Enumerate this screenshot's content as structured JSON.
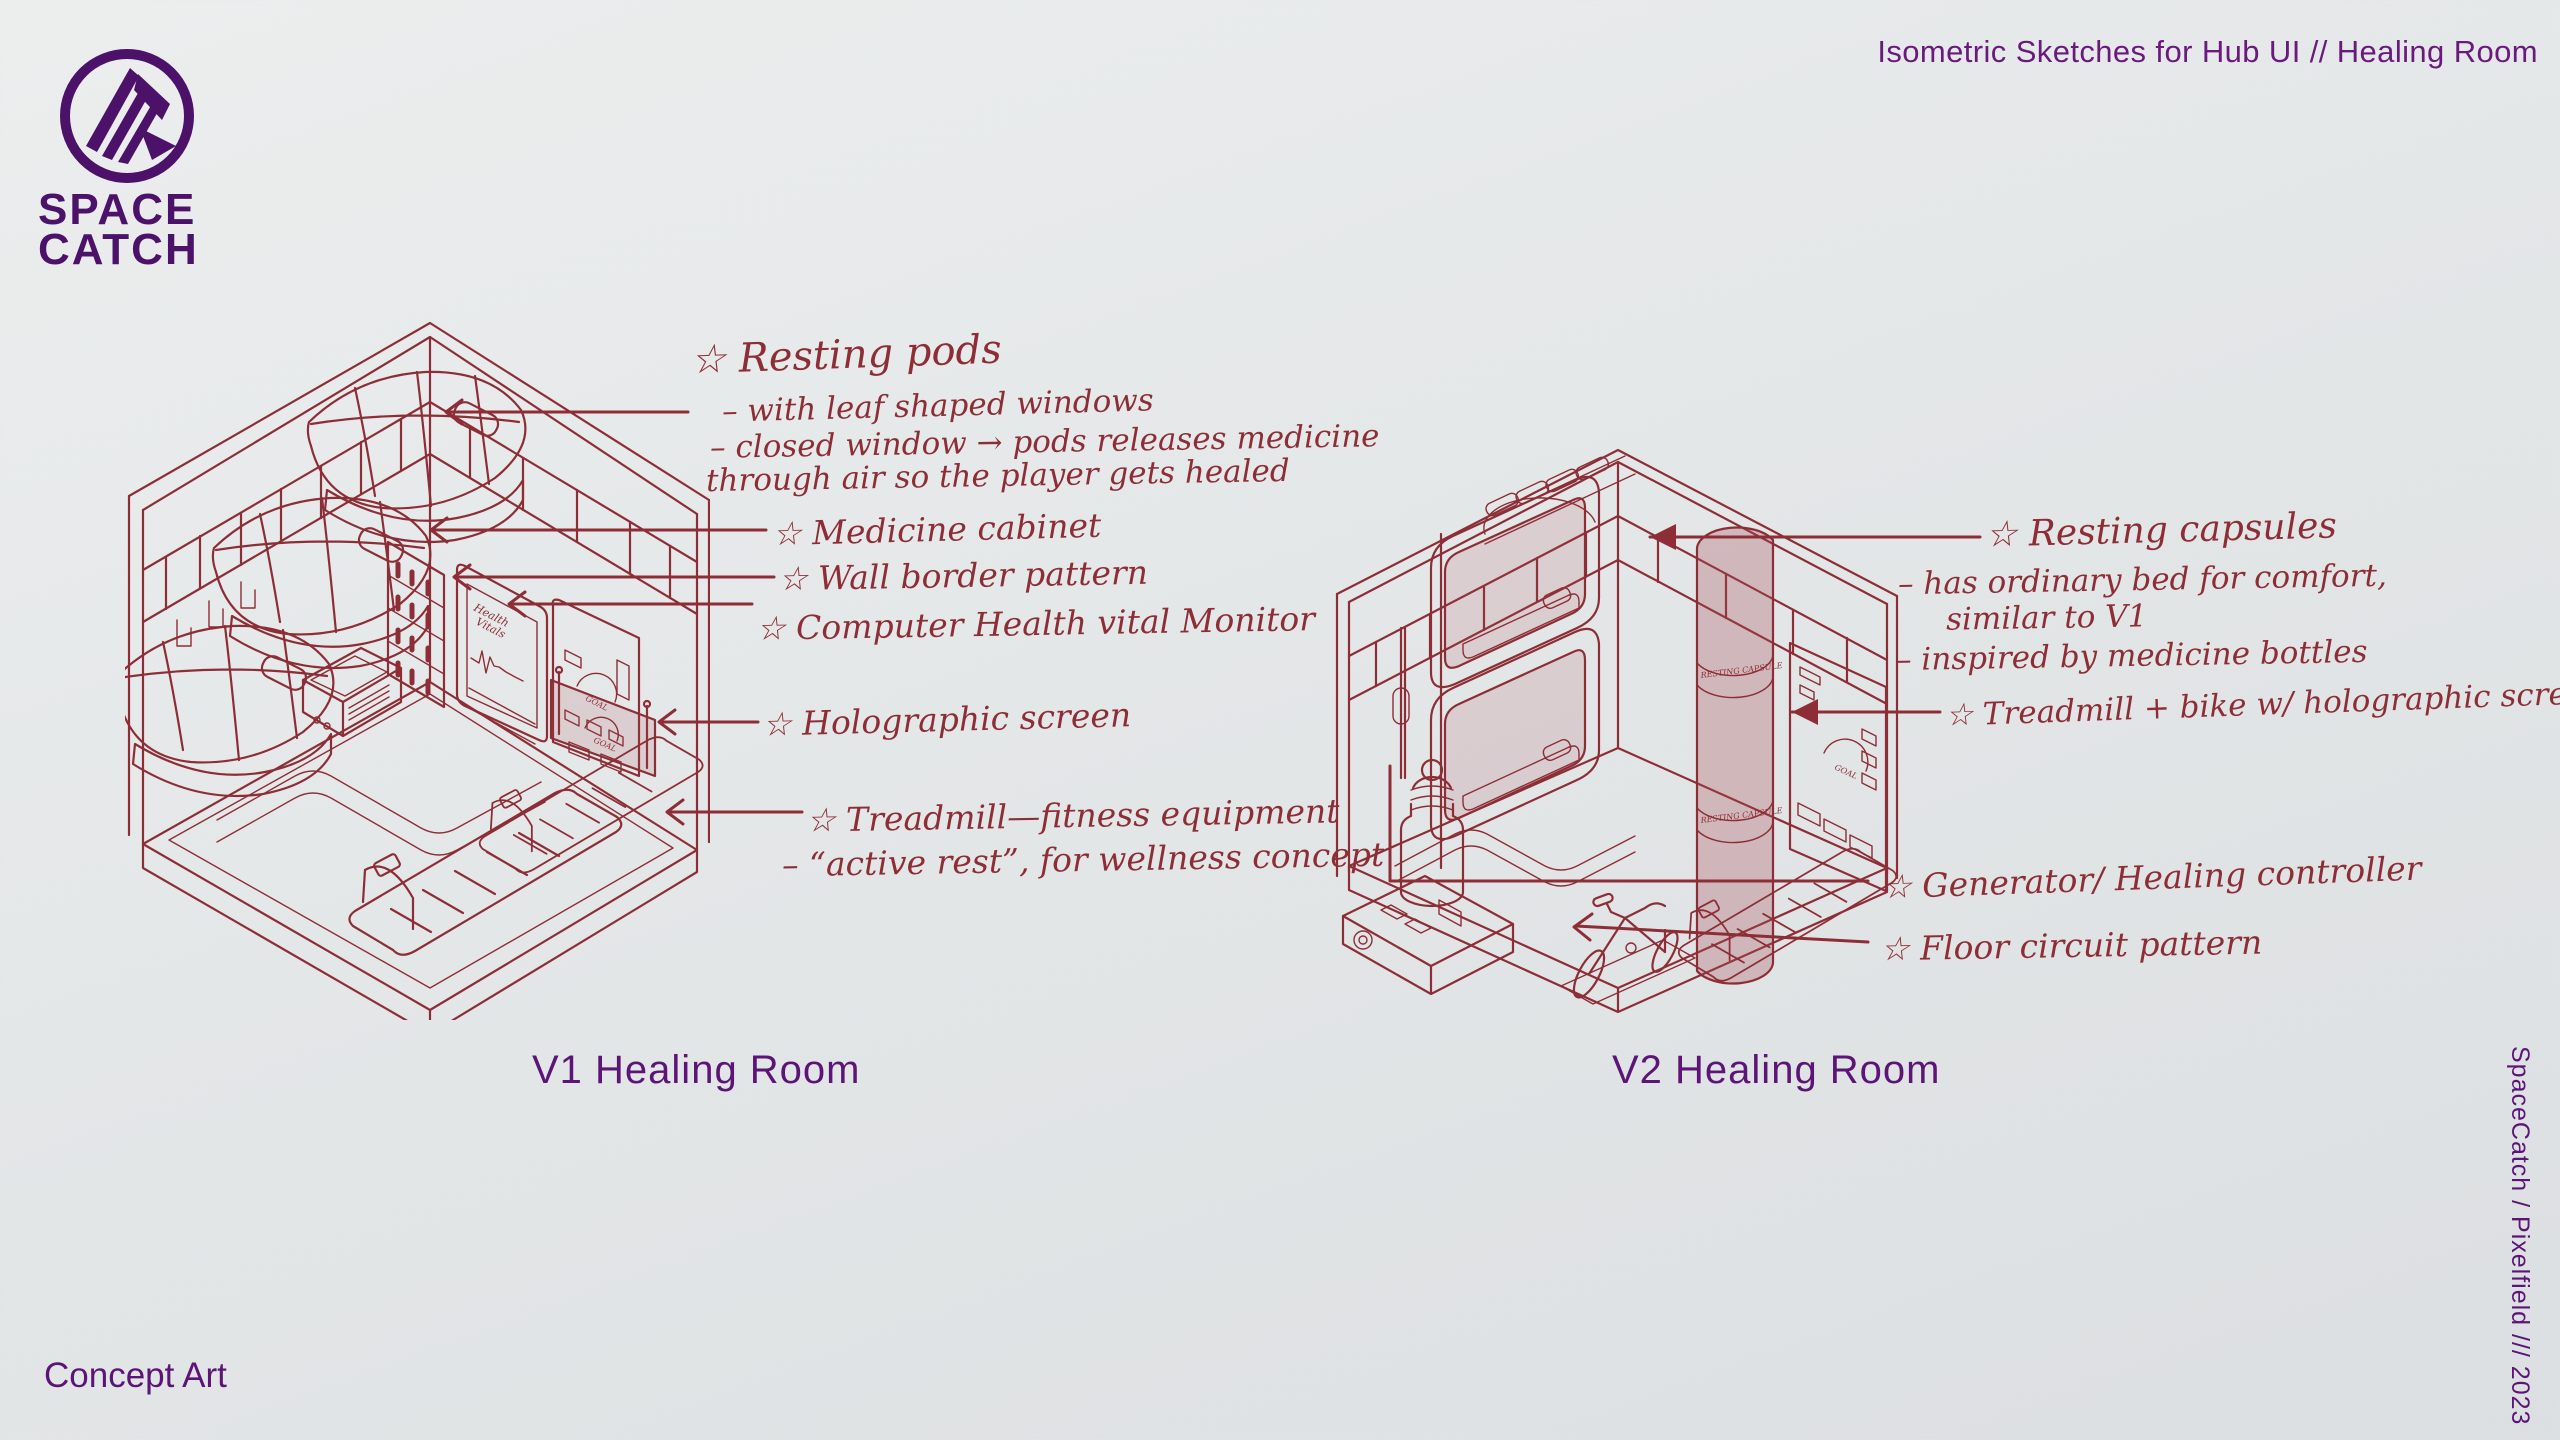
{
  "header": {
    "title": "Isometric Sketches for Hub UI // Healing Room"
  },
  "brand": {
    "line1": "SPACE",
    "line2": "CATCH",
    "logo_icon": "spacecatch-mountain-logo"
  },
  "v1": {
    "label": "V1 Healing Room",
    "annotations": [
      "☆ Resting pods",
      "– with leaf shaped windows",
      "– closed window → pods releases medicine",
      "through air so the player gets healed",
      "☆ Medicine cabinet",
      "☆ Wall border pattern",
      "☆ Computer Health vital Monitor",
      "☆ Holographic screen",
      "☆ Treadmill—fitness equipment",
      "– “active rest”, for wellness concept"
    ]
  },
  "v2": {
    "label": "V2 Healing Room",
    "annotations": [
      "☆ Resting capsules",
      "– has ordinary bed for comfort,",
      "similar to V1",
      "– inspired by medicine bottles",
      "☆ Treadmill + bike w/ holographic screens",
      "☆ Generator/ Healing controller",
      "☆ Floor circuit pattern"
    ]
  },
  "drawing_labels": {
    "capsule_band": "RESTING CAPSULE",
    "monitor_line1": "Health",
    "monitor_line2": "Vitals",
    "gauge": "GOAL"
  },
  "footer": {
    "left": "Concept Art",
    "credit": "SpaceCatch / Pixelfield /// 2023"
  },
  "colors": {
    "accent_purple": "#5c1577",
    "logo_purple": "#4c1168",
    "ink_maroon": "#8d2e36",
    "glass_pink": "rgba(167,77,87,0.30)",
    "background": "#e4e7e8"
  }
}
